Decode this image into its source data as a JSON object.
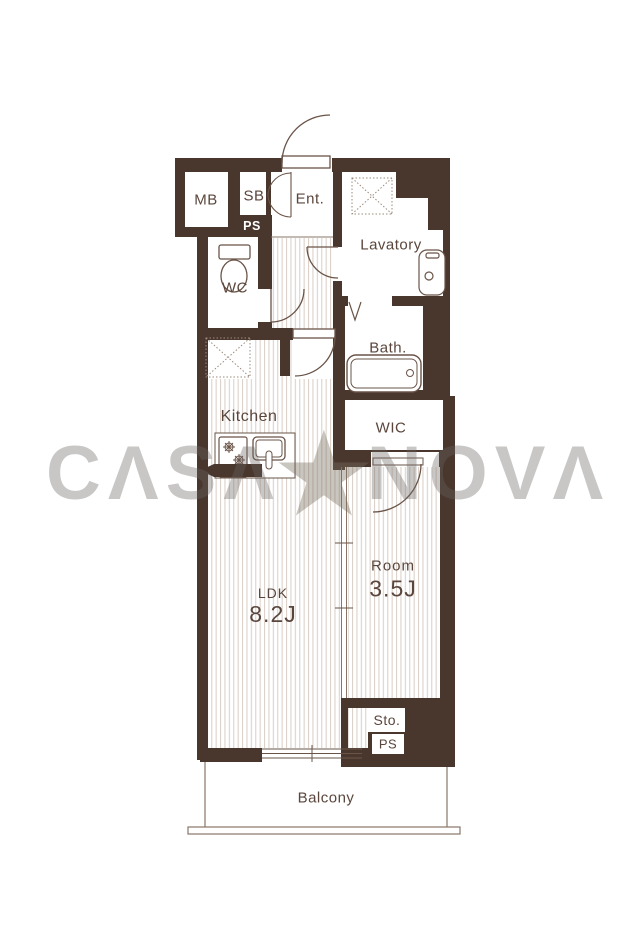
{
  "plan": {
    "rooms": {
      "mb": "MB",
      "sb": "SB",
      "ps_upper": "PS",
      "entrance": "Ent.",
      "lavatory": "Lavatory",
      "wc": "WC",
      "bath": "Bath.",
      "kitchen": "Kitchen",
      "wic": "WIC",
      "ldk": {
        "name": "LDK",
        "size": "8.2J"
      },
      "bedroom": {
        "name": "Room",
        "size": "3.5J"
      },
      "storage": "Sto.",
      "ps_lower": "PS",
      "balcony": "Balcony"
    },
    "icons": [
      "toilet-icon",
      "washbasin-icon",
      "bathtub-icon",
      "stove-icon",
      "kitchen-sink-icon",
      "ceiling-hatch-icon",
      "folding-door-icon"
    ],
    "colors": {
      "wall": "#49372e",
      "line": "#6a5448",
      "floor_stripe": "#dcd2ca",
      "label_text": "#5a463c",
      "watermark_gray": "#c9c6c3"
    }
  },
  "watermark": {
    "brand": "CASA★NOVA",
    "left": "CΛSΛ",
    "star": "★",
    "right": "NOVΛ"
  }
}
